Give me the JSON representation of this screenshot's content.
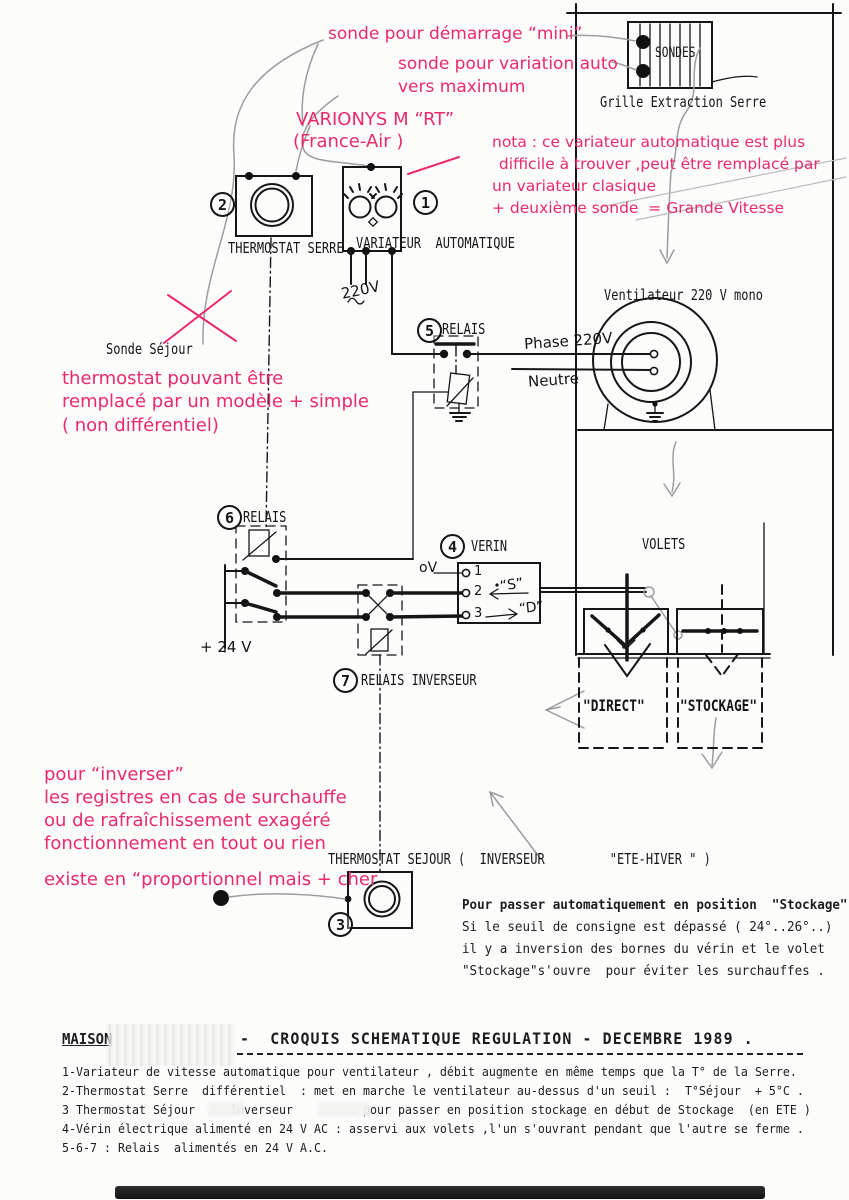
{
  "pink": {
    "sonde_demarrage": "sonde pour démarrage “mini”",
    "sonde_variation": "sonde pour variation auto",
    "vers_maximum": "vers maximum",
    "varionys": "VARIONYS M “RT”",
    "france_air": "(France-Air )",
    "nota1": "nota : ce variateur automatique est plus",
    "nota2": " difficile à trouver ,peut être remplacé par",
    "nota3": "un variateur clasique",
    "nota4": "+ deuxième sonde  = Grande Vitesse",
    "thermo1": "thermostat pouvant être",
    "thermo2": "remplacé par un modèle + simple",
    "thermo3": "( non différentiel)",
    "inv1": "pour “inverser”",
    "inv2": "les registres en cas de surchauffe",
    "inv3": "ou de rafraîchissement exagéré",
    "inv4": "fonctionnement en tout ou rien",
    "prop": "existe en “proportionnel mais + cher"
  },
  "schematic": {
    "sondes": "SONDES",
    "grille": "Grille Extraction Serre",
    "thermostat_serre": "THERMOSTAT SERRE",
    "variateur": "VARIATEUR  AUTOMATIQUE",
    "ventilateur": "Ventilateur 220 V mono",
    "relais5": "RELAIS",
    "relais6": "RELAIS",
    "relais7": "RELAIS INVERSEUR",
    "verin": "VERIN",
    "volets": "VOLETS",
    "direct": "\"DIRECT\"",
    "stockage": "\"STOCKAGE\"",
    "thermostat_sejour": "THERMOSTAT SEJOUR",
    "inverseur_ete_hiver": "(  INVERSEUR         \"ETE-HIVER \" )",
    "num1": "1",
    "num2": "2",
    "num3": "3",
    "num4": "4",
    "num5": "5",
    "num6": "6",
    "num7": "7",
    "v220": "220V",
    "phase": "Phase 220V",
    "neutre": "Neutre",
    "plus24": "+ 24 V",
    "zerov": "oV",
    "sonde_sejour": "Sonde Séjour",
    "t1": "1",
    "t2": "2",
    "t3": "3",
    "s_label": "“S”",
    "d_label": "“D”"
  },
  "note": {
    "l1": "Pour passer automatiquement en position  \"Stockage\":",
    "l2": "Si le seuil de consigne est dépassé ( 24°..26°..)",
    "l3": "il y a inversion des bornes du vérin et le volet",
    "l4": "\"Stockage\"s'ouvre  pour éviter les surchauffes ."
  },
  "footer": {
    "maison": "MAISON",
    "title": "-  CROQUIS SCHEMATIQUE REGULATION - DECEMBRE 1989 .",
    "lines": [
      "1-Variateur de vitesse automatique pour ventilateur , débit augmente en même temps que la T° de la Serre.",
      "2-Thermostat Serre  différentiel  : met en marche le ventilateur au-dessus d'un seuil :  T°Séjour  + 5°C .",
      "3 Thermostat Séjour     Inverseur        : pour passer en position stockage en début de Stockage  (en ETE )",
      "4-Vérin électrique alimenté en 24 V AC : asservi aux volets ,l'un s'ouvrant pendant que l'autre se ferme .",
      "5-6-7 : Relais  alimentés en 24 V A.C."
    ]
  },
  "colors": {
    "pink": "#ea2a6a",
    "ink": "#161616",
    "pencil": "#9d9d9d"
  }
}
